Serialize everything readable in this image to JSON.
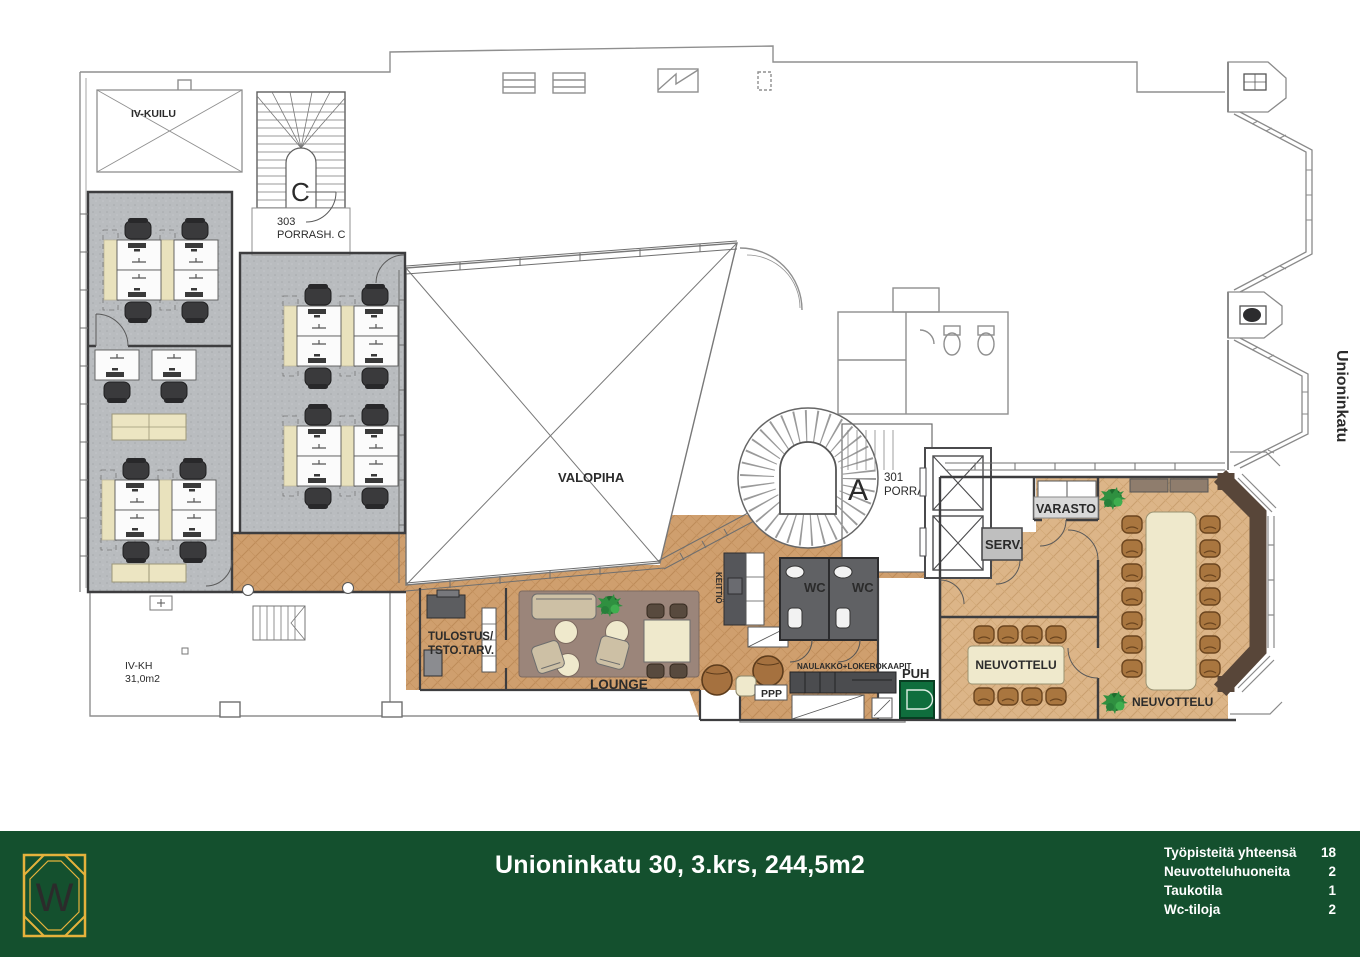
{
  "footer": {
    "title": "Unioninkatu 30, 3.krs, 244,5m2",
    "logo_letter": "W",
    "bg_color": "#14502e",
    "gold_color": "#e5b23c",
    "stats": [
      {
        "label": "Työpisteitä yhteensä",
        "value": "18"
      },
      {
        "label": "Neuvotteluhuoneita",
        "value": "2"
      },
      {
        "label": "Taukotila",
        "value": "1"
      },
      {
        "label": "Wc-tiloja",
        "value": "2"
      }
    ]
  },
  "plan": {
    "street_label": "Unioninkatu",
    "rooms": {
      "iv_kuilu": "IV-KUILU",
      "stair_c_letter": "C",
      "stair_c_number": "303",
      "stair_c_name": "PORRASH. C",
      "valopiha": "VALOPIHA",
      "stair_a_letter": "A",
      "stair_a_number": "301",
      "stair_a_name": "PORRASH. A",
      "wc1": "WC",
      "wc2": "WC",
      "serv": "SERV.",
      "varasto": "VARASTO",
      "meeting_large": "NEUVOTTELU",
      "meeting_small": "NEUVOTTELU",
      "tulostus_line1": "TULOSTUS/",
      "tulostus_line2": "TSTO.TARV.",
      "lounge": "LOUNGE",
      "keittio": "KEITTIÖ",
      "naulakko": "NAULAKKO+LOKEROKAAPIT",
      "puh": "PUH",
      "ppp": "PPP",
      "iv_kh_line1": "IV-KH",
      "iv_kh_line2": "31,0m2"
    }
  }
}
